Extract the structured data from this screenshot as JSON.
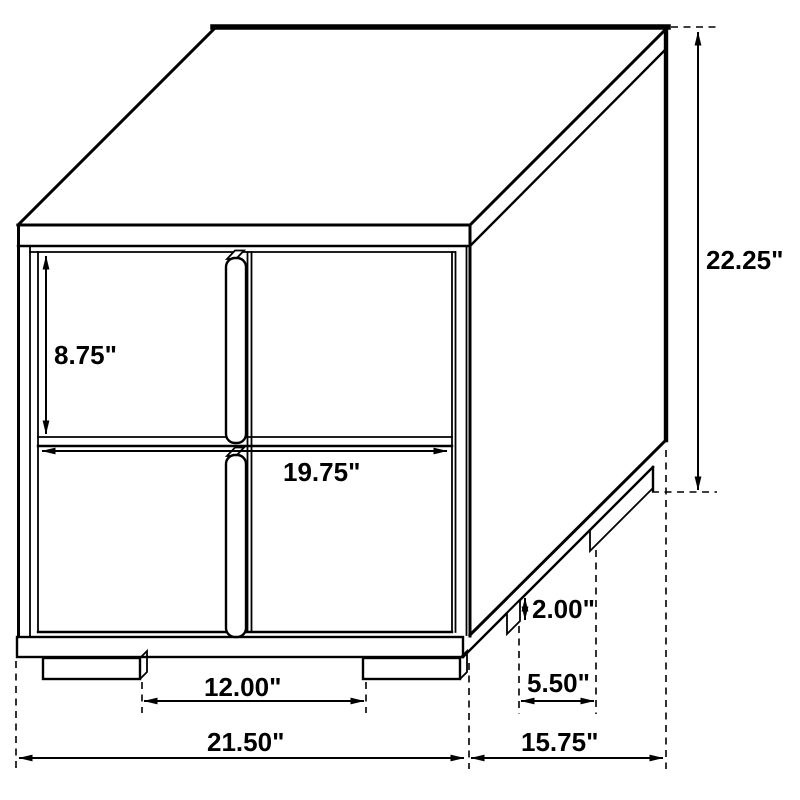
{
  "diagram": {
    "subject": "two-drawer nightstand line drawing with dimension callouts",
    "unit_format": "inches",
    "line_color": "#000000",
    "text_color": "#000000",
    "background_color": "#ffffff",
    "dimensions": {
      "overall_height": "22.25\"",
      "drawer_front_height": "8.75\"",
      "drawer_front_width": "19.75\"",
      "front_leg_spacing": "12.00\"",
      "overall_width": "21.50\"",
      "leg_height": "2.00\"",
      "side_leg_spacing": "5.50\"",
      "overall_depth": "15.75\""
    }
  }
}
